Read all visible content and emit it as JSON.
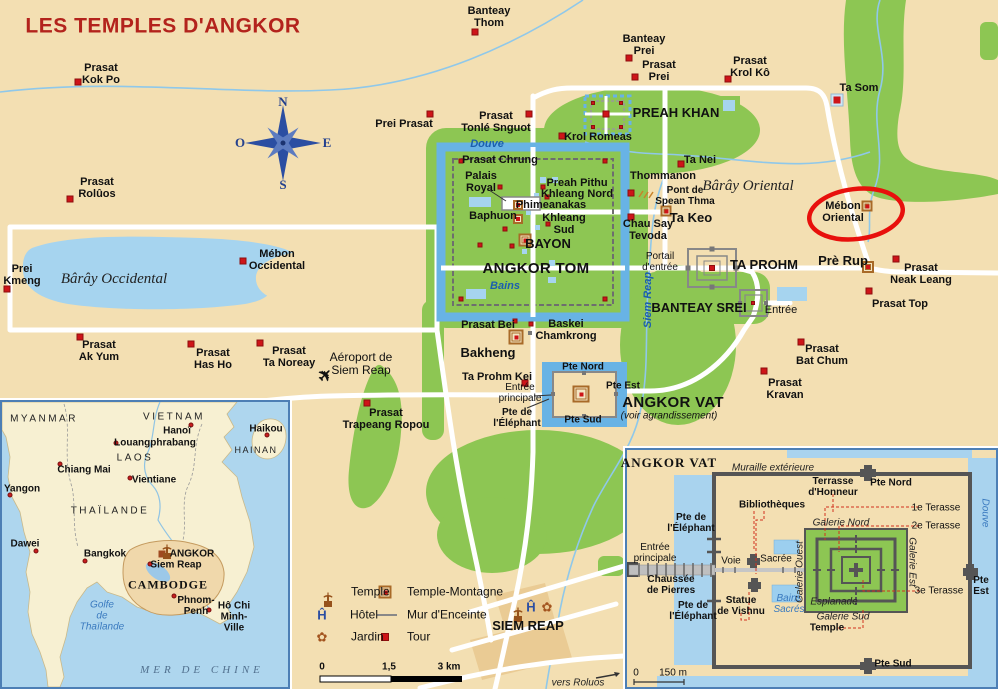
{
  "title": "LES TEMPLES D'ANGKOR",
  "compass": {
    "north": "N",
    "west": "O",
    "east": "E",
    "south": "S"
  },
  "colors": {
    "land": "#F3DFB2",
    "forest": "#8DC653",
    "lake": "#A6D4EF",
    "moat": "#68B3E5",
    "road": "#FFFFFF",
    "marker_red": "#CE1418",
    "title_red": "#B3231C",
    "ellipse_red": "#E8100C",
    "inset_border": "#4D7FB5"
  },
  "legend": {
    "items": [
      {
        "icon": "temple",
        "label": "Temple",
        "ix": 322,
        "lx": 351,
        "y": 592
      },
      {
        "icon": "tm",
        "label": "Temple-Montagne",
        "ix": 385,
        "lx": 407,
        "y": 592
      },
      {
        "icon": "hotel",
        "label": "Hôtel",
        "ix": 322,
        "lx": 350,
        "y": 615
      },
      {
        "icon": "wall",
        "label": "Mur d'Enceinte",
        "ix": 385,
        "lx": 407,
        "y": 615
      },
      {
        "icon": "jardin",
        "label": "Jardin",
        "ix": 322,
        "lx": 351,
        "y": 637
      },
      {
        "icon": "tour",
        "label": "Tour",
        "ix": 385,
        "lx": 407,
        "y": 637
      }
    ],
    "scale": {
      "start": "0",
      "mid": "1,5",
      "end": "3 km"
    }
  },
  "main_map": {
    "labels": [
      {
        "t": "Prasat\nKok Po",
        "x": 101,
        "y": 74
      },
      {
        "t": "Prasat\nRolûos",
        "x": 97,
        "y": 188
      },
      {
        "t": "Banteay\nThom",
        "x": 489,
        "y": 17
      },
      {
        "t": "Banteay\nPrei",
        "x": 644,
        "y": 45
      },
      {
        "t": "Prasat\nPrei",
        "x": 659,
        "y": 71
      },
      {
        "t": "Prasat\nKrol Kô",
        "x": 750,
        "y": 67
      },
      {
        "t": "Ta Som",
        "x": 859,
        "y": 88
      },
      {
        "t": "Prei Prasat",
        "x": 404,
        "y": 124
      },
      {
        "t": "Prasat\nTonlé Snguot",
        "x": 496,
        "y": 122
      },
      {
        "t": "PREAH KHAN",
        "x": 676,
        "y": 113,
        "c": "md"
      },
      {
        "t": "Krol Romeas",
        "x": 598,
        "y": 137
      },
      {
        "t": "Douve",
        "x": 487,
        "y": 144,
        "c": "bi"
      },
      {
        "t": "Prasat Chrung",
        "x": 500,
        "y": 160
      },
      {
        "t": "Ta Nei",
        "x": 700,
        "y": 160
      },
      {
        "t": "Palais\nRoyal",
        "x": 481,
        "y": 182
      },
      {
        "t": "Preah Pithu",
        "x": 577,
        "y": 183
      },
      {
        "t": "Khleang Nord",
        "x": 577,
        "y": 194
      },
      {
        "t": "Phimeanakas",
        "x": 551,
        "y": 205
      },
      {
        "t": "Baphuon",
        "x": 493,
        "y": 216
      },
      {
        "t": "Khleang\nSud",
        "x": 564,
        "y": 224
      },
      {
        "t": "BAYON",
        "x": 548,
        "y": 244,
        "c": "md"
      },
      {
        "t": "ANGKOR TOM",
        "x": 536,
        "y": 269,
        "c": "big"
      },
      {
        "t": "Bains",
        "x": 505,
        "y": 286,
        "c": "bi"
      },
      {
        "t": "Thommanon",
        "x": 663,
        "y": 176
      },
      {
        "t": "Pont de\nSpean Thma",
        "x": 685,
        "y": 196,
        "c": "sm"
      },
      {
        "t": "Ta Keo",
        "x": 691,
        "y": 218,
        "c": "md"
      },
      {
        "t": "Chau Say\nTevoda",
        "x": 648,
        "y": 230
      },
      {
        "t": "Bârây Oriental",
        "x": 748,
        "y": 186,
        "c": "si"
      },
      {
        "t": "Mébon\nOriental",
        "x": 843,
        "y": 212
      },
      {
        "t": "TA PROHM",
        "x": 764,
        "y": 265,
        "c": "md"
      },
      {
        "t": "Portail\nd'entrée",
        "x": 660,
        "y": 262,
        "c": "reg sm"
      },
      {
        "t": "Prè Rup",
        "x": 843,
        "y": 261,
        "c": "md"
      },
      {
        "t": "Prasat\nNeak Leang",
        "x": 921,
        "y": 274
      },
      {
        "t": "Prasat Top",
        "x": 900,
        "y": 304
      },
      {
        "t": "BANTEAY SREI",
        "x": 699,
        "y": 308,
        "c": "md"
      },
      {
        "t": "Entrée",
        "x": 781,
        "y": 310,
        "c": "reg"
      },
      {
        "t": "Prasat\nBat Chum",
        "x": 822,
        "y": 355
      },
      {
        "t": "Prasat\nKravan",
        "x": 785,
        "y": 389
      },
      {
        "t": "Siem Reap",
        "x": 648,
        "y": 300,
        "c": "bi sm",
        "r": -90
      },
      {
        "t": "ANGKOR VAT",
        "x": 673,
        "y": 403,
        "c": "big"
      },
      {
        "t": "(voir agrandissement)",
        "x": 669,
        "y": 416,
        "c": "it sm"
      },
      {
        "t": "Pte Nord",
        "x": 583,
        "y": 367,
        "c": "sm"
      },
      {
        "t": "Pte Est",
        "x": 623,
        "y": 386,
        "c": "sm"
      },
      {
        "t": "Pte Sud",
        "x": 583,
        "y": 420,
        "c": "sm"
      },
      {
        "t": "Entrée\nprincipale",
        "x": 520,
        "y": 393,
        "c": "reg sm"
      },
      {
        "t": "Pte de\nl'Éléphant",
        "x": 517,
        "y": 418,
        "c": "sm"
      },
      {
        "t": "Prasat Bei",
        "x": 488,
        "y": 325
      },
      {
        "t": "Baskei\nChamkrong",
        "x": 566,
        "y": 330
      },
      {
        "t": "Bakheng",
        "x": 488,
        "y": 353,
        "c": "md"
      },
      {
        "t": "Ta Prohm Kei",
        "x": 497,
        "y": 377
      },
      {
        "t": "Aéroport de\nSiem Reap",
        "x": 361,
        "y": 364,
        "c": "reg md2"
      },
      {
        "t": "Prasat\nTrapeang Ropou",
        "x": 386,
        "y": 419
      },
      {
        "t": "Prei\nKmeng",
        "x": 22,
        "y": 275
      },
      {
        "t": "Bârây Occidental",
        "x": 114,
        "y": 279,
        "c": "si"
      },
      {
        "t": "Mébon\nOccidental",
        "x": 277,
        "y": 260
      },
      {
        "t": "Prasat\nAk Yum",
        "x": 99,
        "y": 351
      },
      {
        "t": "Prasat\nHas Ho",
        "x": 213,
        "y": 359
      },
      {
        "t": "Prasat\nTa Noreay",
        "x": 289,
        "y": 357
      },
      {
        "t": "SIEM REAP",
        "x": 528,
        "y": 626,
        "c": "md"
      },
      {
        "t": "vers Roluos",
        "x": 578,
        "y": 683,
        "c": "it10"
      },
      {
        "t": "N",
        "x": 283,
        "y": 102,
        "c": "cmp"
      },
      {
        "t": "O",
        "x": 240,
        "y": 143,
        "c": "cmp"
      },
      {
        "t": "E",
        "x": 327,
        "y": 143,
        "c": "cmp"
      },
      {
        "t": "S",
        "x": 283,
        "y": 185,
        "c": "cmp"
      }
    ],
    "markers": {
      "red": [
        [
          78,
          82
        ],
        [
          70,
          199
        ],
        [
          475,
          32
        ],
        [
          629,
          58
        ],
        [
          635,
          77
        ],
        [
          728,
          79
        ],
        [
          430,
          114
        ],
        [
          529,
          114
        ],
        [
          562,
          136
        ],
        [
          681,
          164
        ],
        [
          631,
          193
        ],
        [
          631,
          217
        ],
        [
          7,
          289
        ],
        [
          243,
          261
        ],
        [
          80,
          337
        ],
        [
          191,
          344
        ],
        [
          260,
          343
        ],
        [
          367,
          403
        ],
        [
          525,
          383
        ],
        [
          896,
          259
        ],
        [
          869,
          291
        ],
        [
          801,
          342
        ],
        [
          764,
          371
        ],
        [
          461,
          161,
          5
        ],
        [
          605,
          161,
          5
        ],
        [
          461,
          299,
          5
        ],
        [
          605,
          299,
          5
        ],
        [
          500,
          187,
          5
        ],
        [
          543,
          187,
          5
        ],
        [
          547,
          197,
          5
        ],
        [
          548,
          224,
          5
        ],
        [
          505,
          229,
          5
        ],
        [
          480,
          245,
          5
        ],
        [
          512,
          246,
          5
        ],
        [
          515,
          321,
          5
        ],
        [
          531,
          324,
          5
        ],
        [
          606,
          114,
          7
        ],
        [
          593,
          103,
          4
        ],
        [
          621,
          103,
          4
        ],
        [
          593,
          127,
          4
        ],
        [
          621,
          127,
          4
        ],
        [
          712,
          268,
          6
        ],
        [
          753,
          303,
          4
        ]
      ],
      "redring": [
        [
          837,
          100
        ]
      ],
      "tm": [
        [
          518,
          205,
          10
        ],
        [
          518,
          219,
          10
        ],
        [
          525,
          240,
          13
        ],
        [
          516,
          337,
          15
        ],
        [
          666,
          211,
          11
        ],
        [
          868,
          267,
          12
        ],
        [
          867,
          206,
          11
        ],
        [
          581,
          394,
          17
        ]
      ],
      "graysq": [
        [
          688,
          268,
          5
        ],
        [
          736,
          268,
          5
        ],
        [
          712,
          249,
          5
        ],
        [
          712,
          287,
          5
        ],
        [
          740,
          303,
          4
        ],
        [
          766,
          303,
          4
        ],
        [
          584,
          373,
          4
        ],
        [
          584,
          416,
          4
        ],
        [
          553,
          394,
          4
        ],
        [
          616,
          394,
          4
        ],
        [
          530,
          333,
          4
        ]
      ],
      "temple": [
        [
          512,
          607
        ]
      ],
      "hotel": [
        [
          531,
          607
        ]
      ],
      "jardin": [
        [
          547,
          607
        ]
      ]
    }
  },
  "inset_region": {
    "labels": [
      {
        "t": "MYANMAR",
        "x": 42,
        "y": 17,
        "c": "ls"
      },
      {
        "t": "VIETNAM",
        "x": 172,
        "y": 15,
        "c": "ls"
      },
      {
        "t": "Hanoï",
        "x": 175,
        "y": 29,
        "c": "b10"
      },
      {
        "t": "Haikou",
        "x": 264,
        "y": 27,
        "c": "b10"
      },
      {
        "t": "HAINAN",
        "x": 254,
        "y": 49,
        "c": "lsx"
      },
      {
        "t": "Louangphrabang",
        "x": 153,
        "y": 41,
        "c": "b10"
      },
      {
        "t": "LAOS",
        "x": 133,
        "y": 56,
        "c": "ls"
      },
      {
        "t": "Chiang Mai",
        "x": 82,
        "y": 68,
        "c": "b10"
      },
      {
        "t": "Vientiane",
        "x": 152,
        "y": 78,
        "c": "b10"
      },
      {
        "t": "Yangon",
        "x": 20,
        "y": 87,
        "c": "b10"
      },
      {
        "t": "THAÏLANDE",
        "x": 108,
        "y": 109,
        "c": "ls"
      },
      {
        "t": "Dawei",
        "x": 23,
        "y": 142,
        "c": "b10"
      },
      {
        "t": "Bangkok",
        "x": 103,
        "y": 152,
        "c": "b10"
      },
      {
        "t": "ANGKOR",
        "x": 190,
        "y": 152,
        "c": "b10"
      },
      {
        "t": "Siem Reap",
        "x": 174,
        "y": 163,
        "c": "b10"
      },
      {
        "t": "CAMBODGE",
        "x": 166,
        "y": 183,
        "c": "serifcaps"
      },
      {
        "t": "Phnom-\nPenh",
        "x": 194,
        "y": 204,
        "c": "b10"
      },
      {
        "t": "Hô Chi Minh-\nVille",
        "x": 232,
        "y": 215,
        "c": "b10"
      },
      {
        "t": "Golfe\nde\nThaïlande",
        "x": 100,
        "y": 214,
        "c": "bi2"
      },
      {
        "t": "MER DE CHINE",
        "x": 200,
        "y": 268,
        "c": "sea"
      }
    ],
    "markers": {
      "dot": [
        [
          189,
          23
        ],
        [
          265,
          33
        ],
        [
          114,
          41
        ],
        [
          58,
          62
        ],
        [
          128,
          76
        ],
        [
          8,
          93
        ],
        [
          34,
          149
        ],
        [
          83,
          159
        ],
        [
          148,
          162
        ],
        [
          172,
          194
        ],
        [
          207,
          208
        ]
      ],
      "sqbrown": [
        [
          160,
          152
        ]
      ],
      "temple": [
        [
          159,
          142
        ]
      ]
    }
  },
  "inset_angkor_vat": {
    "title": "ANGKOR VAT",
    "scale": {
      "start": "0",
      "end": "150 m"
    },
    "labels": [
      {
        "t": "Muraille extérieure",
        "x": 146,
        "y": 18,
        "c": "it10"
      },
      {
        "t": "Terrasse\nd'Honneur",
        "x": 206,
        "y": 37,
        "c": "sm"
      },
      {
        "t": "Pte Nord",
        "x": 264,
        "y": 33,
        "c": "sm"
      },
      {
        "t": "Bibliothèques",
        "x": 145,
        "y": 55,
        "c": "sm"
      },
      {
        "t": "1e Terasse",
        "x": 309,
        "y": 58,
        "c": "reg sm"
      },
      {
        "t": "2e Terasse",
        "x": 309,
        "y": 76,
        "c": "reg sm"
      },
      {
        "t": "Galerie Nord",
        "x": 214,
        "y": 73,
        "c": "it10"
      },
      {
        "t": "Galerie Ouest",
        "x": 173,
        "y": 122,
        "c": "it10",
        "r": -90
      },
      {
        "t": "Galerie Est",
        "x": 285,
        "y": 112,
        "c": "it10",
        "r": 90
      },
      {
        "t": "Pte de\nl'Éléphant",
        "x": 64,
        "y": 73,
        "c": "sm"
      },
      {
        "t": "Entrée\nprincipale",
        "x": 28,
        "y": 103,
        "c": "reg sm"
      },
      {
        "t": "Voie",
        "x": 104,
        "y": 111,
        "c": "reg sm"
      },
      {
        "t": "Sacrée",
        "x": 149,
        "y": 109,
        "c": "reg sm"
      },
      {
        "t": "Chaussée\nde Pierres",
        "x": 44,
        "y": 135,
        "c": "sm"
      },
      {
        "t": "Pte de\nl'Éléphant",
        "x": 66,
        "y": 161,
        "c": "sm"
      },
      {
        "t": "Statue\nde Vishnu",
        "x": 114,
        "y": 156,
        "c": "sm"
      },
      {
        "t": "Bains\nSacrés",
        "x": 162,
        "y": 154,
        "c": "bi2"
      },
      {
        "t": "Esplanade",
        "x": 207,
        "y": 152,
        "c": "it10"
      },
      {
        "t": "Galerie Sud",
        "x": 216,
        "y": 167,
        "c": "it10"
      },
      {
        "t": "Temple",
        "x": 200,
        "y": 178,
        "c": "sm"
      },
      {
        "t": "3e Terasse",
        "x": 312,
        "y": 141,
        "c": "reg sm"
      },
      {
        "t": "Pte Est",
        "x": 354,
        "y": 136,
        "c": "sm"
      },
      {
        "t": "Pte Sud",
        "x": 266,
        "y": 214,
        "c": "sm"
      },
      {
        "t": "Douve",
        "x": 358,
        "y": 63,
        "c": "bi2",
        "r": 90
      }
    ]
  }
}
